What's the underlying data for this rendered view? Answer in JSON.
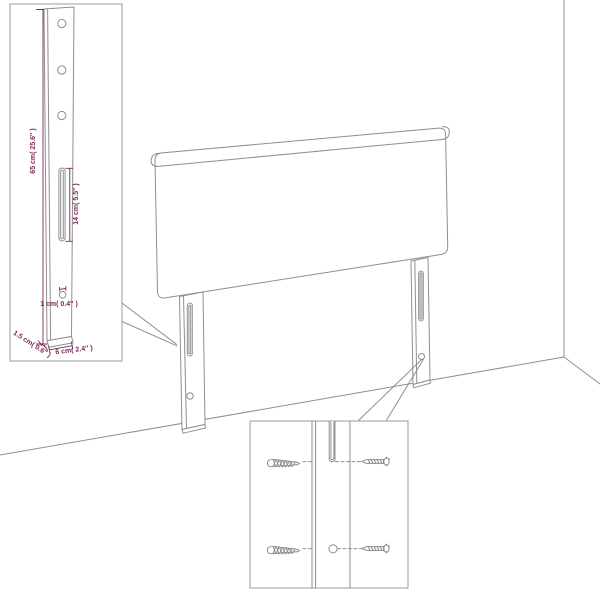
{
  "colors": {
    "background": "#ffffff",
    "line": "#8f8f8f",
    "dimension": "#7b2a58"
  },
  "diagram": {
    "kind": "headboard-assembly-line-drawing",
    "insets": {
      "leg_dimensions": {
        "height_label": "65 cm( 25.6″ )",
        "slot_length_label": "14 cm( 5.5″ )",
        "hole_diameter_label": "1 cm( 0.4″ )",
        "thickness_label": "1.5 cm( 0.6″ )",
        "width_label": "6 cm( 2.4″ )",
        "hole_count": 3
      },
      "screw_detail": {
        "screw_count": 4
      }
    }
  },
  "icons": {
    "threaded_screw": "screw-thread-icon",
    "side_view_screw": "screw-side-icon"
  }
}
